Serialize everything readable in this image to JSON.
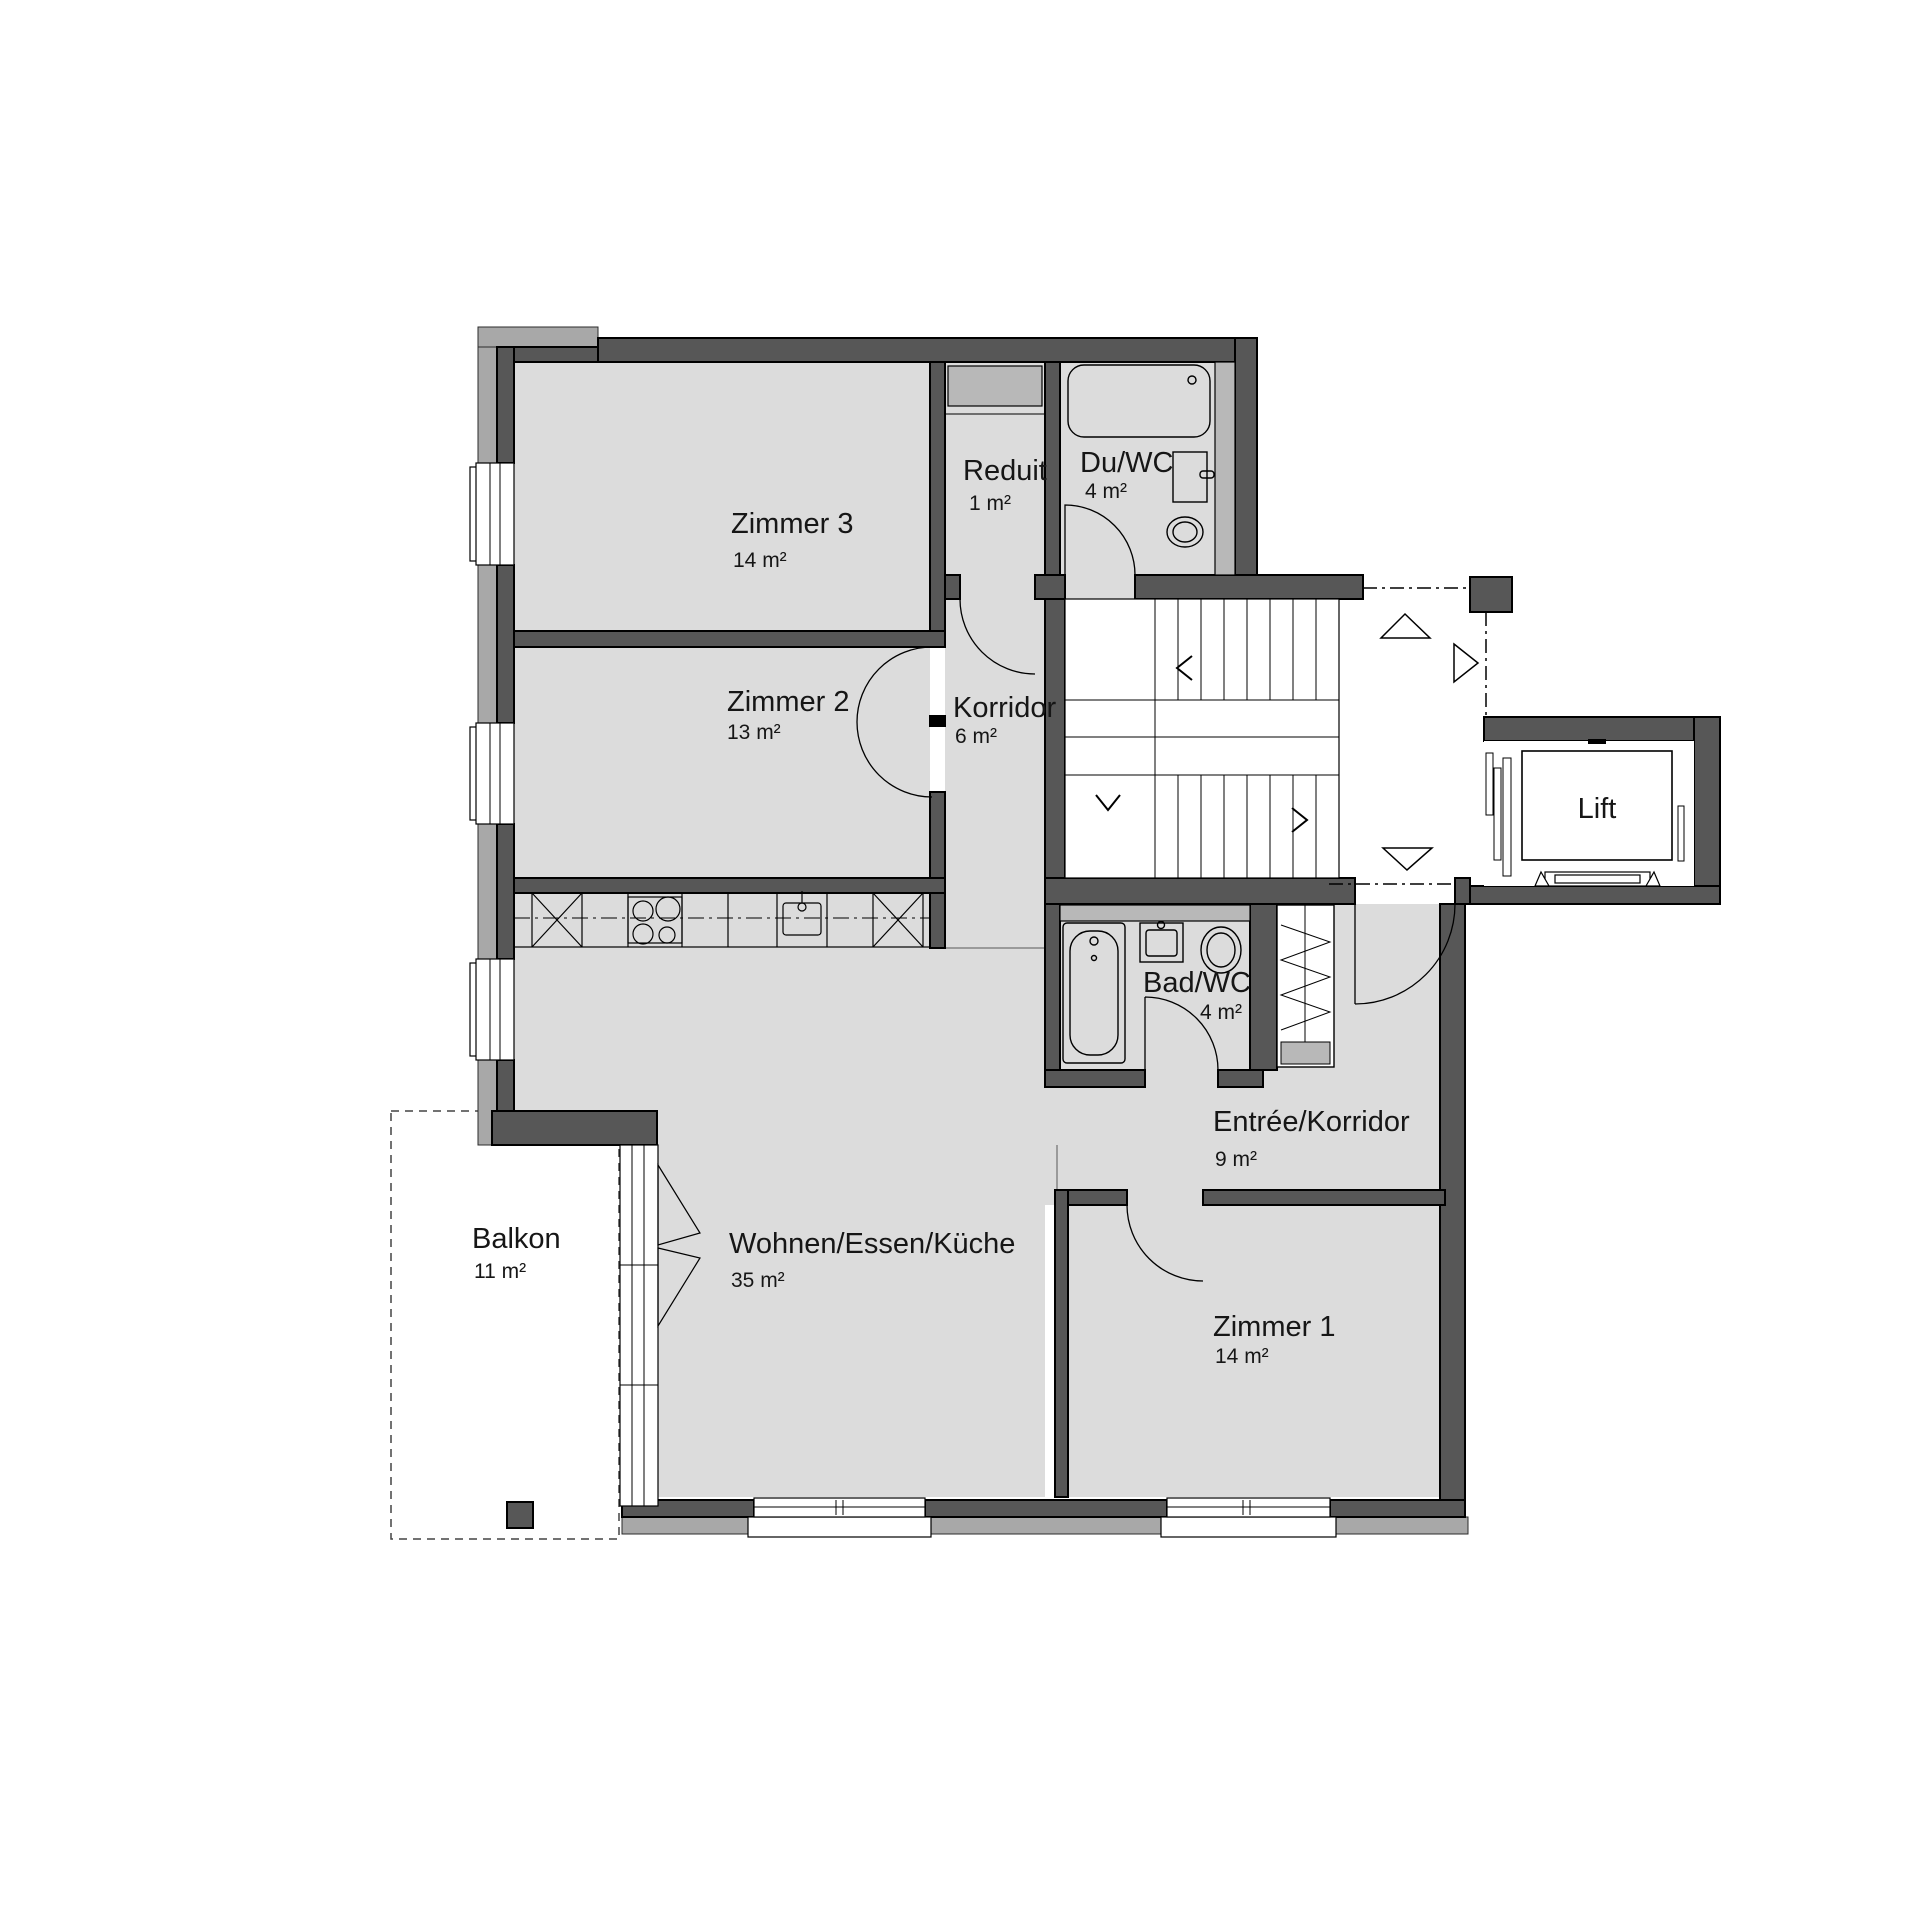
{
  "plan": {
    "type": "apartment-floor-plan",
    "colors": {
      "wall": "#575757",
      "wall_outline": "#000000",
      "floor": "#dcdcdc",
      "exterior_band": "#a8a8a8",
      "shaft": "#b8b8b8",
      "background": "#ffffff"
    },
    "rooms": {
      "zimmer3": {
        "name": "Zimmer 3",
        "area": "14 m²"
      },
      "reduit": {
        "name": "Reduit",
        "area": "1 m²"
      },
      "du_wc": {
        "name": "Du/WC",
        "area": "4 m²"
      },
      "zimmer2": {
        "name": "Zimmer 2",
        "area": "13 m²"
      },
      "korridor": {
        "name": "Korridor",
        "area": "6 m²"
      },
      "bad_wc": {
        "name": "Bad/WC",
        "area": "4 m²"
      },
      "entree": {
        "name": "Entrée/Korridor",
        "area": "9 m²"
      },
      "wohnen": {
        "name": "Wohnen/Essen/Küche",
        "area": "35 m²"
      },
      "zimmer1": {
        "name": "Zimmer 1",
        "area": "14 m²"
      },
      "balkon": {
        "name": "Balkon",
        "area": "11 m²"
      },
      "lift": {
        "name": "Lift"
      }
    }
  }
}
